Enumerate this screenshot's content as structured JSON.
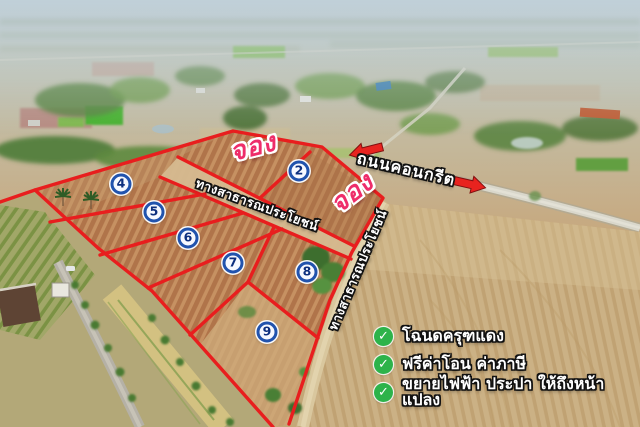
{
  "plots": [
    {
      "number": "2"
    },
    {
      "number": "4"
    },
    {
      "number": "5"
    },
    {
      "number": "6"
    },
    {
      "number": "7"
    },
    {
      "number": "8"
    },
    {
      "number": "9"
    }
  ],
  "overlays": {
    "reserved_label_1": "จอง",
    "reserved_label_2": "จอง",
    "concrete_road_label": "ถนนคอนกรีต",
    "public_way_label_1": "ทางสาธารณประโยชน์",
    "public_way_label_2": "ทางสาธารณประโยชน์"
  },
  "check_glyph": "✓",
  "features": [
    {
      "icon": "check-circle",
      "text": "โฉนดครุฑแดง"
    },
    {
      "icon": "check-circle",
      "text": "ฟรีค่าโอน ค่าภาษี"
    },
    {
      "icon": "check-circle",
      "text": "ขยายไฟฟ้า ประปา ให้ถึงหน้าแปลง"
    }
  ],
  "colors": {
    "boundary_red": "#e81e1e",
    "reserved_pink": "#ee2d6a",
    "badge_ring_blue": "#2153ad",
    "badge_number_navy": "#0d2f7e",
    "check_green": "#2db34a",
    "label_white": "#ffffff"
  }
}
